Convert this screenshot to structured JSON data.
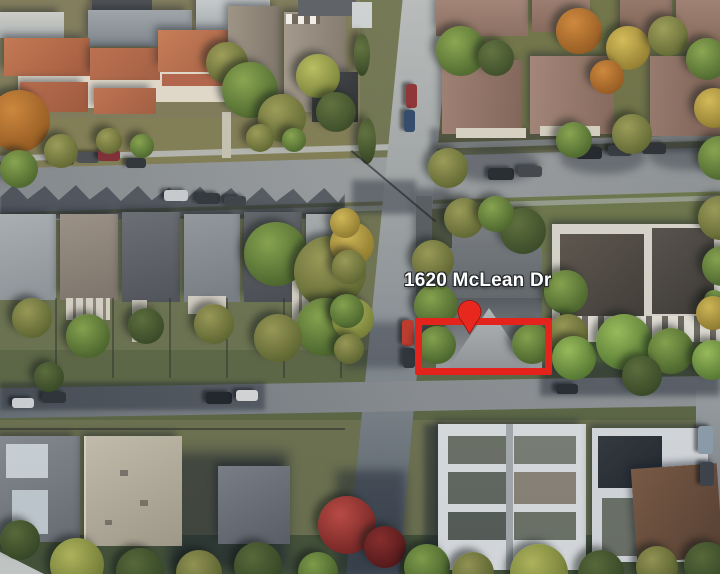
{
  "map": {
    "imagery": "satellite-aerial",
    "address_label": "1620 McLean Dr",
    "label_style": {
      "color": "#ffffff",
      "outline": "#23272b"
    },
    "marker": {
      "icon": "location-pin",
      "color": "#e8281e"
    },
    "highlight": {
      "shape": "rectangle",
      "color": "#e3231c"
    }
  }
}
